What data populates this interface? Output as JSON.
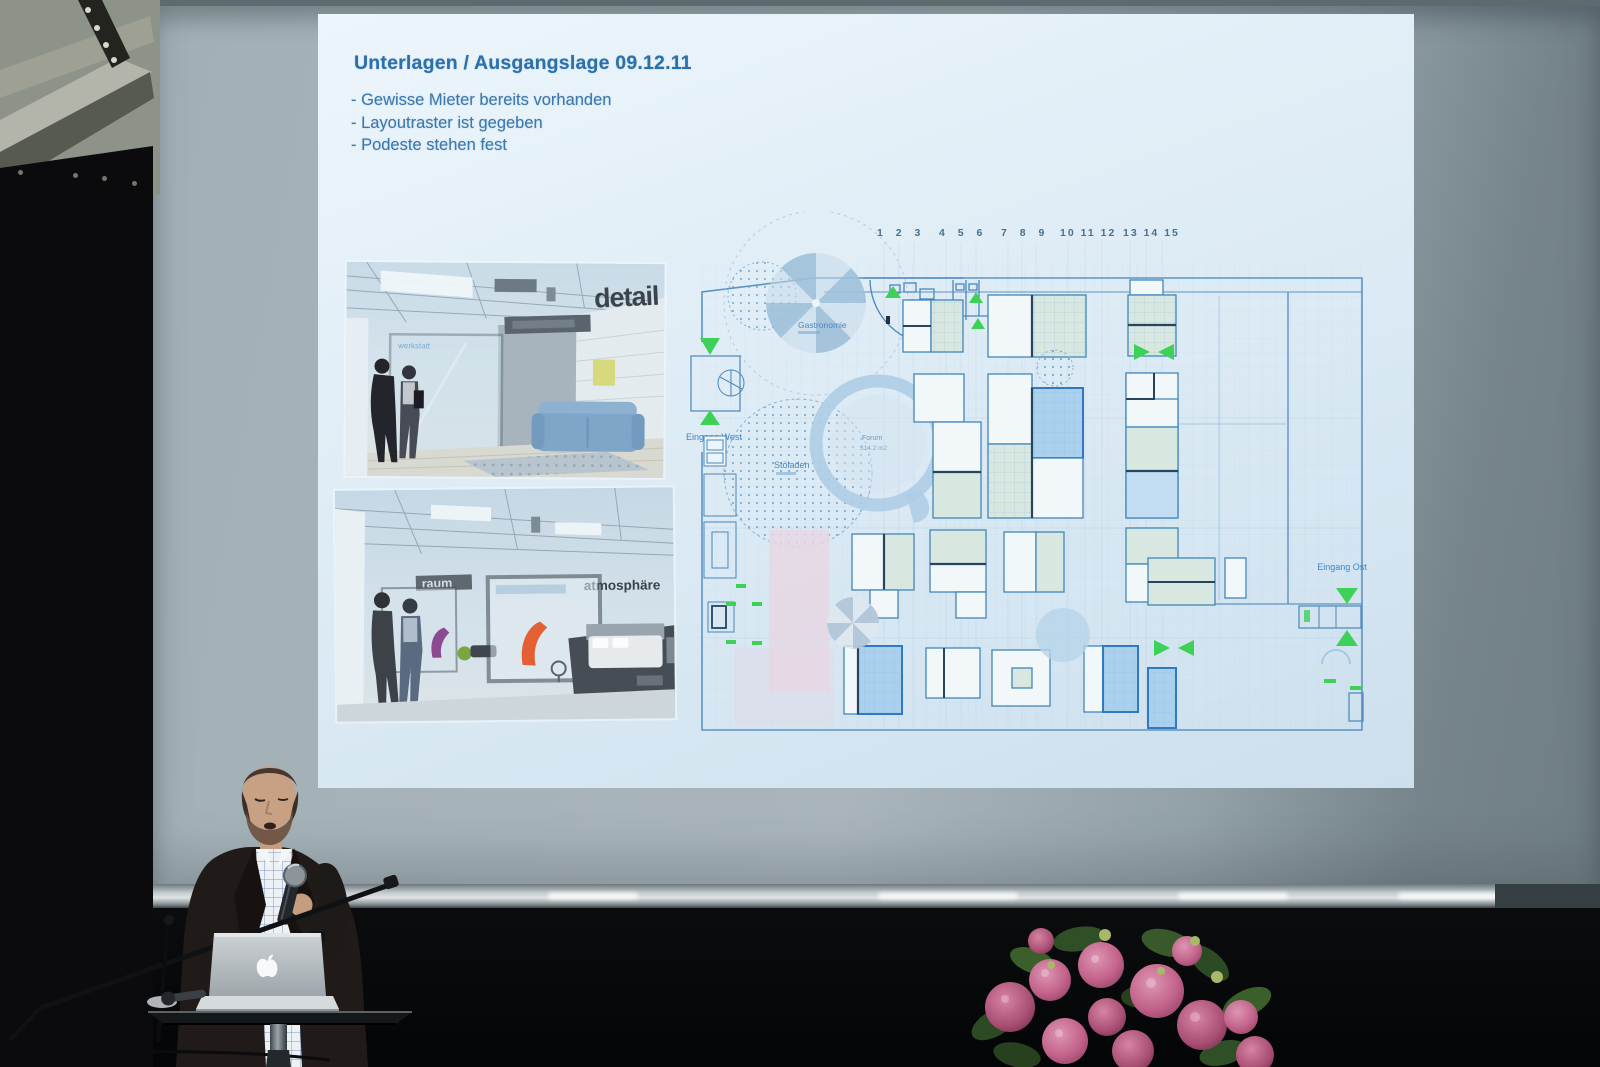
{
  "photo": {
    "slide": {
      "title": "Unterlagen / Ausgangslage 09.12.11",
      "bullets": [
        "- Gewisse Mieter bereits vorhanden",
        "- Layoutraster ist gegeben",
        "- Podeste stehen fest"
      ],
      "renders": {
        "top_caption": "detail",
        "glass_label": "werkstatt",
        "bottom_left_caption": "raum",
        "bottom_right_caption": "atmosphäre"
      },
      "floorplan": {
        "number_groups": [
          "1 2 3",
          "4 5 6",
          "7 8 9",
          "10 11 12",
          "13 14 15"
        ],
        "gastronomie_label": "Gastronomie",
        "stoffladen_label": "Stöladen",
        "forum_label": "Forum",
        "forum_area": "314.2 m2",
        "entrance_west_label": "Eingang West",
        "entrance_east_label": "Eingang Ost"
      }
    },
    "colors": {
      "title_blue": "#2b6fab",
      "plan_line_blue": "#5d93c2",
      "plan_dark_wall": "#27445f",
      "arrow_green": "#3ed158",
      "pink_zone": "#e6d7e3"
    }
  }
}
